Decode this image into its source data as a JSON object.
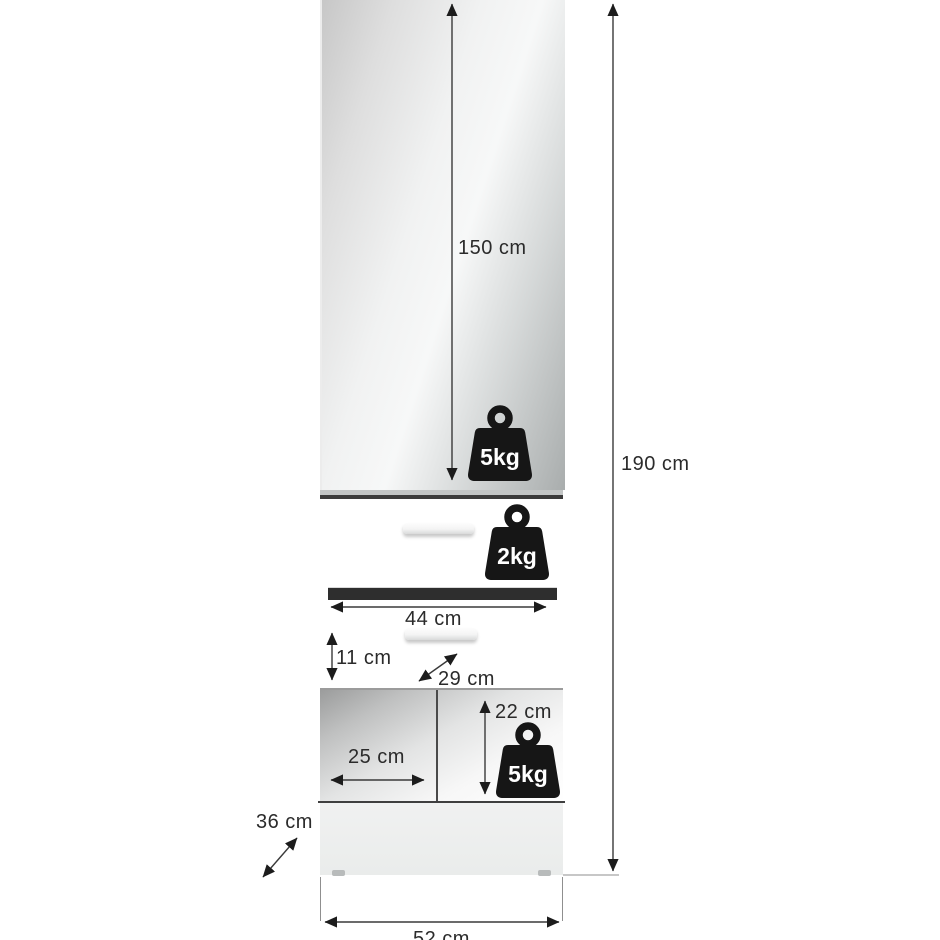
{
  "diagram": {
    "type": "furniture-dimension-diagram",
    "dim": {
      "door_height": "150 cm",
      "total_height": "190 cm",
      "drawer_width": "44 cm",
      "drawer_front_height": "11 cm",
      "drawer_depth": "29 cm",
      "shelf_height": "22 cm",
      "shelf_width": "25 cm",
      "plinth_depth": "36 cm",
      "total_width": "52 cm"
    },
    "load_limits": {
      "mirror_door_section": "5kg",
      "drawer": "2kg",
      "open_shelf": "5kg"
    },
    "icons": {
      "weight": "weight-kettlebell-icon"
    },
    "colors": {
      "dimension_line": "#3a3a3a",
      "arrowhead": "#1c1c1c",
      "label_text": "#2b2b2b",
      "weight_icon": "#161616",
      "weight_text": "#ffffff",
      "mirror_silver_light": "#f6f6f6",
      "mirror_silver_dark": "#a9adad",
      "drawer_front": "#ffffff",
      "recess_dark": "#2e2e2e",
      "base_gray": "#eef0ef",
      "background": "#ffffff"
    }
  }
}
